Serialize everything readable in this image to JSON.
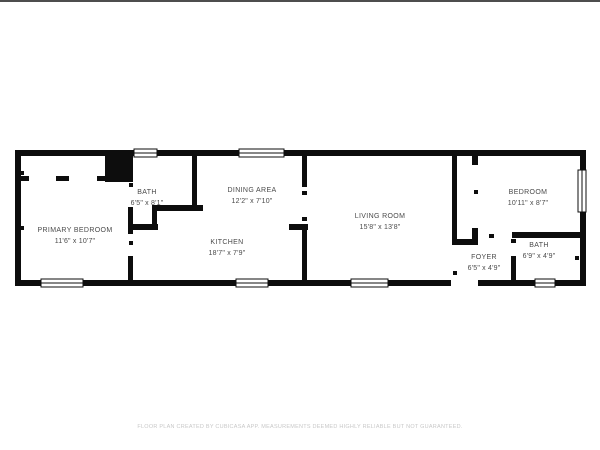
{
  "colors": {
    "bg": "#ffffff",
    "wall": "#0d0d0d",
    "label": "#4a4a4a",
    "footer": "#c8c8c8",
    "top_line": "#4d4d4d"
  },
  "rooms": [
    {
      "name": "PRIMARY BEDROOM",
      "dims": "11'6\" x 10'7\""
    },
    {
      "name": "BATH",
      "dims": "6'5\" x 8'1\""
    },
    {
      "name": "DINING AREA",
      "dims": "12'2\" x 7'10\""
    },
    {
      "name": "KITCHEN",
      "dims": "18'7\" x 7'9\""
    },
    {
      "name": "LIVING ROOM",
      "dims": "15'8\" x 13'8\""
    },
    {
      "name": "BEDROOM",
      "dims": "10'11\" x 8'7\""
    },
    {
      "name": "FOYER",
      "dims": "6'5\" x 4'9\""
    },
    {
      "name": "BATH",
      "dims": "6'9\" x 4'9\""
    }
  ],
  "footer": {
    "text": "FLOOR PLAN CREATED BY CUBICASA APP. MEASUREMENTS DEEMED HIGHLY RELIABLE BUT NOT GUARANTEED."
  },
  "floorplan": {
    "walls": [
      [
        15,
        150,
        571,
        6
      ],
      [
        15,
        280,
        571,
        6
      ],
      [
        15,
        150,
        6,
        136
      ],
      [
        580,
        150,
        6,
        136
      ],
      [
        21,
        176,
        8,
        5
      ],
      [
        56,
        176,
        13,
        5
      ],
      [
        97,
        176,
        10,
        5
      ],
      [
        105,
        153,
        28,
        29
      ],
      [
        128,
        207,
        5,
        27
      ],
      [
        128,
        256,
        5,
        25
      ],
      [
        192,
        156,
        5,
        51
      ],
      [
        152,
        205,
        51,
        6
      ],
      [
        152,
        211,
        5,
        19
      ],
      [
        128,
        224,
        30,
        6
      ],
      [
        302,
        156,
        5,
        31
      ],
      [
        289,
        224,
        19,
        6
      ],
      [
        302,
        224,
        5,
        57
      ],
      [
        452,
        156,
        5,
        89
      ],
      [
        452,
        239,
        26,
        6
      ],
      [
        472,
        228,
        6,
        11
      ],
      [
        472,
        150,
        6,
        15
      ],
      [
        512,
        232,
        68,
        6
      ],
      [
        511,
        256,
        5,
        25
      ]
    ],
    "gaps": [
      [
        451,
        279,
        27,
        8
      ]
    ],
    "windows": [
      {
        "x": 134,
        "y": 149,
        "w": 23,
        "h": 8,
        "o": "h"
      },
      {
        "x": 239,
        "y": 149,
        "w": 45,
        "h": 8,
        "o": "h"
      },
      {
        "x": 578,
        "y": 170,
        "w": 8,
        "h": 42,
        "o": "v"
      },
      {
        "x": 41,
        "y": 279,
        "w": 42,
        "h": 8,
        "o": "h"
      },
      {
        "x": 236,
        "y": 279,
        "w": 32,
        "h": 8,
        "o": "h"
      },
      {
        "x": 351,
        "y": 279,
        "w": 37,
        "h": 8,
        "o": "h"
      },
      {
        "x": 535,
        "y": 279,
        "w": 20,
        "h": 8,
        "o": "h"
      }
    ],
    "ticks": [
      [
        129,
        183,
        4,
        4
      ],
      [
        129,
        241,
        4,
        4
      ],
      [
        302,
        191,
        5,
        4
      ],
      [
        302,
        217,
        5,
        4
      ],
      [
        474,
        190,
        4,
        4
      ],
      [
        489,
        234,
        5,
        4
      ],
      [
        453,
        271,
        4,
        4
      ],
      [
        511,
        239,
        5,
        4
      ],
      [
        575,
        256,
        4,
        4
      ],
      [
        21,
        171,
        3,
        4
      ],
      [
        21,
        226,
        3,
        4
      ]
    ]
  }
}
